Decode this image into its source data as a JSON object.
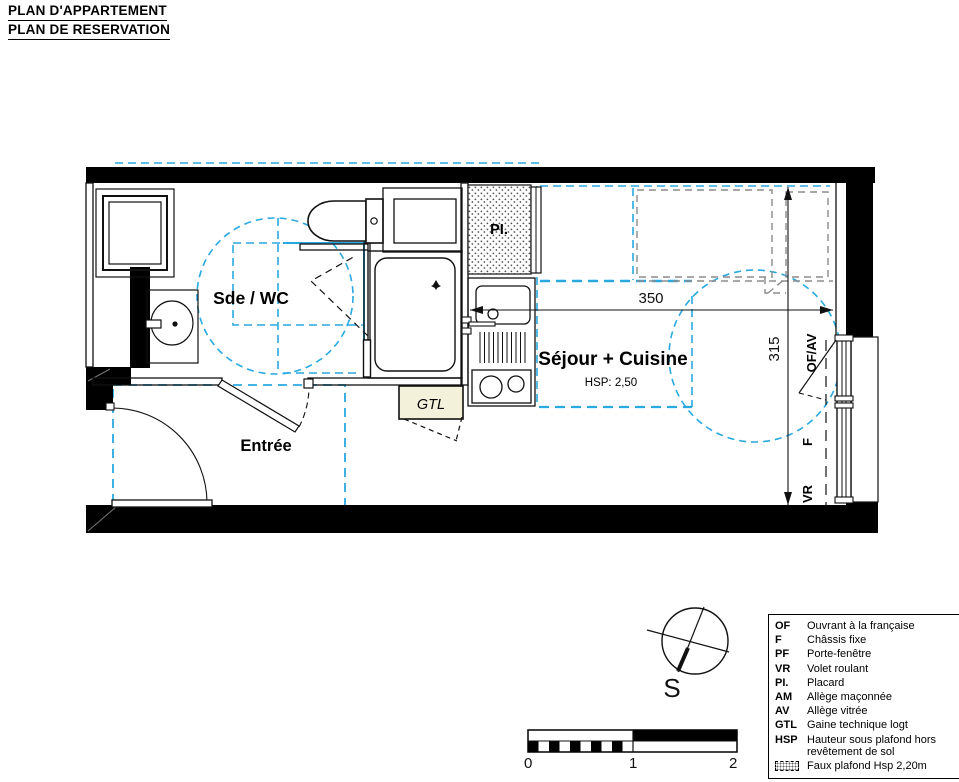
{
  "title": {
    "line1": "PLAN D'APPARTEMENT",
    "line2": "PLAN DE RESERVATION"
  },
  "rooms": {
    "bathroom_label": "Sde / WC",
    "entry_label": "Entrée",
    "living_label": "Séjour + Cuisine",
    "living_hsp": "HSP: 2,50",
    "closet_label": "PI.",
    "duct_label": "GTL"
  },
  "dimensions": {
    "width_cm": "350",
    "depth_cm": "315"
  },
  "window_labels": {
    "upper": "OF/AV",
    "middle": "F",
    "lower": "VR"
  },
  "compass": {
    "south_label": "S"
  },
  "scale_bar": {
    "labels": [
      "0",
      "1",
      "2"
    ]
  },
  "legend": {
    "items": [
      {
        "abbr": "OF",
        "desc": "Ouvrant à la française"
      },
      {
        "abbr": "F",
        "desc": "Châssis fixe"
      },
      {
        "abbr": "PF",
        "desc": "Porte-fenêtre"
      },
      {
        "abbr": "VR",
        "desc": "Volet roulant"
      },
      {
        "abbr": "PI.",
        "desc": "Placard"
      },
      {
        "abbr": "AM",
        "desc": "Allège maçonnée"
      },
      {
        "abbr": "AV",
        "desc": "Allège vitrée"
      },
      {
        "abbr": "GTL",
        "desc": "Gaine technique logt"
      },
      {
        "abbr": "HSP",
        "desc": "Hauteur sous plafond hors revêtement de sol"
      },
      {
        "abbr": "",
        "desc": "Faux plafond Hsp 2,20m"
      }
    ]
  },
  "colors": {
    "accessibility_blue": "#29a9e1",
    "faux_plafond_gray": "#8c8c8c",
    "gtl_fill": "#f4f1da",
    "wall_black": "#000000"
  }
}
